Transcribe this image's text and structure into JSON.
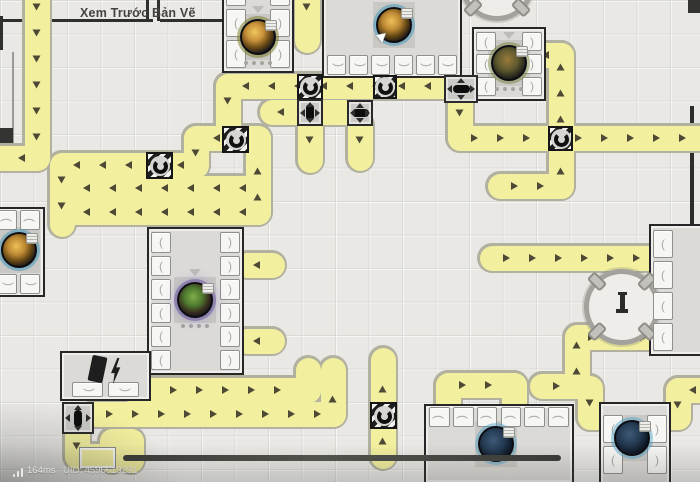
{
  "hud": {
    "preview_label": "Xem Trước Bản Vẽ",
    "ping": "164ms",
    "uid": "UID: 4596619291"
  },
  "colors": {
    "belt_fill": "#f2ef9e",
    "belt_edge": "#b2b1a0",
    "arrow": "#4d4935",
    "machine_border": "#262626",
    "hazard_dark": "#1d1d1d",
    "bar": "#3e3e3c"
  },
  "scene": {
    "belt": {
      "thickness": 25,
      "outline": 30,
      "arrow_gap": 26
    },
    "belts": [
      {
        "id": "west-edge-drop",
        "points": [
          [
            37,
            -8
          ],
          [
            37,
            158
          ],
          [
            -8,
            158
          ]
        ]
      },
      {
        "id": "tunnel-loop",
        "points": [
          [
            258,
            212
          ],
          [
            258,
            138
          ],
          [
            196,
            138
          ],
          [
            196,
            165
          ],
          [
            62,
            165
          ],
          [
            62,
            224
          ]
        ]
      },
      {
        "id": "west-run-a",
        "points": [
          [
            258,
            188
          ],
          [
            72,
            188
          ]
        ]
      },
      {
        "id": "west-run-b",
        "points": [
          [
            258,
            212
          ],
          [
            66,
            212
          ]
        ]
      },
      {
        "id": "north-run",
        "points": [
          [
            443,
            86
          ],
          [
            228,
            86
          ],
          [
            228,
            130
          ]
        ]
      },
      {
        "id": "splitter-east-run",
        "points": [
          [
            460,
            98
          ],
          [
            460,
            138
          ],
          [
            708,
            138
          ]
        ]
      },
      {
        "id": "refinery-feed",
        "points": [
          [
            500,
            186
          ],
          [
            561,
            186
          ],
          [
            561,
            55
          ],
          [
            538,
            55
          ]
        ]
      },
      {
        "id": "east-dock-top",
        "points": [
          [
            492,
            258
          ],
          [
            652,
            258
          ]
        ]
      },
      {
        "id": "east-dock-bottom",
        "points": [
          [
            542,
            386
          ],
          [
            577,
            386
          ],
          [
            577,
            337
          ],
          [
            652,
            337
          ]
        ]
      },
      {
        "id": "south-run-a",
        "points": [
          [
            133,
            368
          ],
          [
            133,
            390
          ],
          [
            308,
            390
          ],
          [
            308,
            370
          ]
        ]
      },
      {
        "id": "south-run-b",
        "points": [
          [
            95,
            414
          ],
          [
            333,
            414
          ],
          [
            333,
            370
          ]
        ]
      },
      {
        "id": "south-tunnel-stub",
        "points": [
          [
            383,
            456
          ],
          [
            383,
            360
          ]
        ]
      },
      {
        "id": "south-bridge",
        "points": [
          [
            448,
            402
          ],
          [
            448,
            385
          ],
          [
            514,
            385
          ],
          [
            514,
            402
          ]
        ]
      },
      {
        "id": "dock-left-feed",
        "points": [
          [
            590,
            388
          ],
          [
            590,
            417
          ],
          [
            606,
            417
          ]
        ]
      },
      {
        "id": "dock-right-feed",
        "points": [
          [
            708,
            390
          ],
          [
            678,
            390
          ],
          [
            678,
            417
          ],
          [
            662,
            417
          ]
        ]
      },
      {
        "id": "sw-stub",
        "points": [
          [
            77,
            431
          ],
          [
            77,
            456
          ],
          [
            98,
            456
          ]
        ]
      },
      {
        "id": "sw-uturn",
        "points": [
          [
            112,
            460
          ],
          [
            112,
            441
          ],
          [
            131,
            441
          ],
          [
            131,
            460
          ]
        ]
      },
      {
        "id": "s1-down-stub",
        "points": [
          [
            310,
            125
          ],
          [
            310,
            160
          ]
        ]
      },
      {
        "id": "s2-down-stub",
        "points": [
          [
            360,
            125
          ],
          [
            360,
            158
          ]
        ]
      },
      {
        "id": "s1-s2-link",
        "points": [
          [
            324,
            112
          ],
          [
            346,
            112
          ]
        ]
      },
      {
        "id": "s1-west-stub",
        "points": [
          [
            296,
            112
          ],
          [
            272,
            112
          ]
        ]
      },
      {
        "id": "assembler-in-top",
        "points": [
          [
            272,
            265
          ],
          [
            247,
            265
          ]
        ]
      },
      {
        "id": "assembler-in-bottom",
        "points": [
          [
            272,
            341
          ],
          [
            247,
            341
          ]
        ]
      },
      {
        "id": "top-stub",
        "points": [
          [
            307,
            -8
          ],
          [
            307,
            40
          ]
        ]
      }
    ],
    "tunnels": [
      {
        "x": 222,
        "y": 126,
        "s": 27
      },
      {
        "x": 146,
        "y": 152,
        "s": 27
      },
      {
        "x": 297,
        "y": 74,
        "s": 26
      },
      {
        "x": 373,
        "y": 75,
        "s": 24
      },
      {
        "x": 548,
        "y": 126,
        "s": 25
      },
      {
        "x": 370,
        "y": 402,
        "s": 27
      }
    ],
    "splitters": [
      {
        "x": 297,
        "y": 99,
        "w": 26,
        "h": 27,
        "o": "v"
      },
      {
        "x": 347,
        "y": 100,
        "w": 26,
        "h": 26,
        "o": "h"
      },
      {
        "x": 444,
        "y": 75,
        "w": 34,
        "h": 28,
        "o": "h"
      },
      {
        "x": 62,
        "y": 402,
        "w": 32,
        "h": 32,
        "o": "v"
      }
    ],
    "machines": [
      {
        "id": "smelter-a",
        "x": 222,
        "y": -28,
        "w": 72,
        "h": 101,
        "slots": "lr",
        "n": 3,
        "orb": {
          "cx": 258,
          "cy": 37,
          "style": "gold"
        },
        "deco": true
      },
      {
        "id": "smelter-b",
        "x": 322,
        "y": -42,
        "w": 140,
        "h": 120,
        "slots": "b",
        "n": 6,
        "orb": {
          "cx": 394,
          "cy": 25,
          "style": "goldcube"
        },
        "cursor": true
      },
      {
        "id": "smelter-c",
        "x": 472,
        "y": 27,
        "w": 74,
        "h": 74,
        "slots": "lr",
        "n": 3,
        "orb": {
          "cx": 509,
          "cy": 63,
          "style": "olive"
        },
        "deco": true
      },
      {
        "id": "assembler",
        "x": 147,
        "y": 227,
        "w": 97,
        "h": 148,
        "slots": "lr",
        "n": 6,
        "orb": {
          "cx": 195,
          "cy": 300,
          "style": "planet"
        },
        "deco": true
      },
      {
        "id": "dock-se",
        "x": 599,
        "y": 402,
        "w": 72,
        "h": 84,
        "slots": "lr",
        "n": 2,
        "orb": {
          "cx": 632,
          "cy": 438,
          "style": "navy"
        }
      },
      {
        "id": "dock-e",
        "x": 649,
        "y": 224,
        "w": 60,
        "h": 132,
        "slots": "l",
        "n": 4
      },
      {
        "id": "power-plant",
        "x": 60,
        "y": 351,
        "w": 91,
        "h": 50,
        "slots": "g",
        "n": 2,
        "icon": "power"
      },
      {
        "id": "smelter-w",
        "x": -32,
        "y": 207,
        "w": 77,
        "h": 90,
        "slots": "tb",
        "n": 3,
        "orb": {
          "cx": 19,
          "cy": 250,
          "style": "goldcube"
        }
      },
      {
        "id": "dock-s",
        "x": 424,
        "y": 404,
        "w": 150,
        "h": 80,
        "slots": "t",
        "n": 6,
        "orb": {
          "cx": 496,
          "cy": 444,
          "style": "navy"
        }
      }
    ],
    "circles": [
      {
        "cx": 622,
        "cy": 307,
        "d": 76,
        "icon": true
      },
      {
        "cx": 497,
        "cy": -16,
        "d": 74,
        "icon": false
      }
    ],
    "decor": [
      {
        "x": 0,
        "y": 19,
        "w": 153,
        "h": 3,
        "c": "#2f2f2d"
      },
      {
        "x": 146,
        "y": 0,
        "w": 3,
        "h": 21,
        "c": "#2f2f2d"
      },
      {
        "x": 157,
        "y": 0,
        "w": 3,
        "h": 21,
        "c": "#2f2f2d"
      },
      {
        "x": 160,
        "y": 19,
        "w": 62,
        "h": 3,
        "c": "#2f2f2d"
      },
      {
        "x": 0,
        "y": 16,
        "w": 3,
        "h": 34,
        "c": "#2f2f2d"
      },
      {
        "x": 12,
        "y": 52,
        "w": 2,
        "h": 98,
        "c": "#9a9995"
      },
      {
        "x": 0,
        "y": 128,
        "w": 13,
        "h": 21,
        "c": "#343432"
      },
      {
        "x": 688,
        "y": 0,
        "w": 12,
        "h": 13,
        "c": "#343432"
      },
      {
        "x": 690,
        "y": 106,
        "w": 4,
        "h": 250,
        "c": "#2c2c2a"
      }
    ],
    "bar": {
      "x": 123,
      "y": 455,
      "w": 438,
      "h": 6
    },
    "frame_piece": {
      "x": 80,
      "y": 448,
      "w": 31,
      "h": 16
    }
  }
}
